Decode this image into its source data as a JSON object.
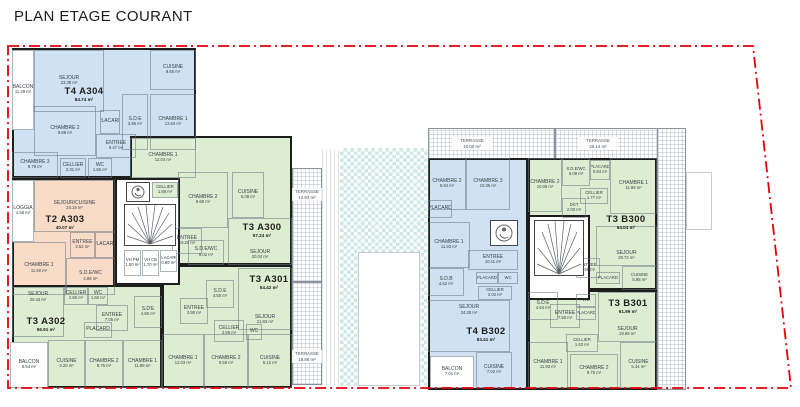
{
  "title": "PLAN ETAGE COURANT",
  "colors": {
    "blue": "#cfe1f2",
    "green": "#dcedd2",
    "orange": "#f8dcc8",
    "wall": "#1d1d1b",
    "boundary": "#e3000b",
    "courtyard": "#cfe7e3"
  },
  "apartments": {
    "a304": {
      "name": "T4  A304",
      "area": "84.74 m²",
      "rooms": {
        "balcon": {
          "n": "BALCON",
          "a": "11.28 m²"
        },
        "sejour": {
          "n": "SEJOUR",
          "a": "23.38 m²"
        },
        "cuisine": {
          "n": "CUISINE",
          "a": "9.65 m²"
        },
        "sde": {
          "n": "S.D.E",
          "a": "3.95 m²"
        },
        "chambre1": {
          "n": "CHAMBRE 1",
          "a": "12.64 m²"
        },
        "chambre2": {
          "n": "CHAMBRE 2",
          "a": "9.88 m²"
        },
        "chambre3": {
          "n": "CHAMBRE 3",
          "a": "9.79 m²"
        },
        "placard": {
          "n": "PLACARD",
          "a": ""
        },
        "entree": {
          "n": "ENTREE",
          "a": "9.47 m²"
        },
        "cellier": {
          "n": "CELLIER",
          "a": "2.31 m²"
        },
        "wc": {
          "n": "WC",
          "a": "1.65 m²"
        }
      }
    },
    "a303": {
      "name": "T2  A303",
      "area": "40.07 m²",
      "rooms": {
        "loggia": {
          "n": "LOGGIA",
          "a": "4.58 m²"
        },
        "sejour_cuisine": {
          "n": "SEJOUR/CUISINE",
          "a": "24.19 m²"
        },
        "entree": {
          "n": "ENTREE",
          "a": "3.52 m²"
        },
        "placard": {
          "n": "PLACARD",
          "a": ""
        },
        "chambre": {
          "n": "CHAMBRE 1",
          "a": "11.50 m²"
        },
        "sde_wc": {
          "n": "S.D.E/WC",
          "a": "4.86 m²"
        }
      }
    },
    "a300": {
      "name": "T3  A300",
      "area": "57.24 m²",
      "rooms": {
        "chambre1": {
          "n": "CHAMBRE 1",
          "a": "12.04 m²"
        },
        "chambre2": {
          "n": "CHAMBRE 2",
          "a": "9.69 m²"
        },
        "cuisine": {
          "n": "CUISINE",
          "a": "5.08 m²"
        },
        "sejour": {
          "n": "SEJOUR",
          "a": "20.04 m²"
        },
        "entree": {
          "n": "ENTREE",
          "a": "10.20 m²"
        },
        "sde_wc": {
          "n": "S.D.E/WC",
          "a": "5.02 m²"
        },
        "cellier": {
          "n": "CELLIER",
          "a": "1.88 m²"
        },
        "terrasse": {
          "n": "TERRASSE",
          "a": "12.93 m²"
        }
      }
    },
    "a301": {
      "name": "T3  A301",
      "area": "54.42 m²",
      "rooms": {
        "sde": {
          "n": "S.D.E",
          "a": "4.50 m²"
        },
        "sejour": {
          "n": "SEJOUR",
          "a": "21.83 m²"
        },
        "entree": {
          "n": "ENTREE",
          "a": "3.90 m²"
        },
        "cellier": {
          "n": "CELLIER",
          "a": "2.65 m²"
        },
        "wc": {
          "n": "WC",
          "a": ""
        },
        "chambre1": {
          "n": "CHAMBRE 1",
          "a": "12.03 m²"
        },
        "chambre2": {
          "n": "CHAMBRE 2",
          "a": "9.58 m²"
        },
        "cuisine": {
          "n": "CUISINE",
          "a": "5.12 m²"
        },
        "terrasse": {
          "n": "TERRASSE",
          "a": "18.88 m²"
        }
      }
    },
    "a302": {
      "name": "T3  A302",
      "area": "55.91 m²",
      "rooms": {
        "sejour": {
          "n": "SEJOUR",
          "a": "20.43 m²"
        },
        "cellier": {
          "n": "CELLIER",
          "a": "2.60 m²"
        },
        "wc": {
          "n": "WC",
          "a": "1.60 m²"
        },
        "entree": {
          "n": "ENTREE",
          "a": "7.05 m²"
        },
        "sde": {
          "n": "S.D'E",
          "a": "4.60 m²"
        },
        "placard": {
          "n": "PLACARD",
          "a": ""
        },
        "cuisine": {
          "n": "CUISINE",
          "a": "4.20 m²"
        },
        "chambre1": {
          "n": "CHAMBRE 1",
          "a": "11.98 m²"
        },
        "chambre2": {
          "n": "CHAMBRE 2",
          "a": "9.75 m²"
        },
        "balcon": {
          "n": "BALCON",
          "a": "8.54 m²"
        }
      }
    },
    "b300": {
      "name": "T3  B300",
      "area": "64.04 m²",
      "rooms": {
        "chambre1": {
          "n": "CHAMBRE 1",
          "a": "11.99 m²"
        },
        "chambre2": {
          "n": "CHAMBRE 2",
          "a": "10.06 m²"
        },
        "sde_wc": {
          "n": "S.D.E/WC",
          "a": "5.09 m²"
        },
        "placard": {
          "n": "PLACARD",
          "a": "0.84 m²"
        },
        "cellier": {
          "n": "CELLIER",
          "a": "1.77 m²"
        },
        "dgt": {
          "n": "DGT",
          "a": "2.00 m²"
        },
        "sejour": {
          "n": "SEJOUR",
          "a": "20.72 m²"
        },
        "entree": {
          "n": "ENTREE",
          "a": "3.98 m²"
        },
        "placard2": {
          "n": "PLACARD",
          "a": "0.70 m²"
        },
        "cuisine": {
          "n": "CUISINE",
          "a": "5.98 m²"
        },
        "terrasse": {
          "n": "TERRASSE",
          "a": "20.14 m²"
        }
      }
    },
    "b301": {
      "name": "T3  B301",
      "area": "61.99 m²",
      "rooms": {
        "sde": {
          "n": "S.D.E",
          "a": "4.54 m²"
        },
        "entree": {
          "n": "ENTREE",
          "a": "7.50 m²"
        },
        "wc": {
          "n": "WC",
          "a": "1.65 m²"
        },
        "placard": {
          "n": "PLACARD",
          "a": "0.92 m²"
        },
        "sejour": {
          "n": "SEJOUR",
          "a": "20.65 m²"
        },
        "cellier": {
          "n": "CELLIER",
          "a": "1.63 m²"
        },
        "chambre1": {
          "n": "CHAMBRE 1",
          "a": "11.93 m²"
        },
        "chambre2": {
          "n": "CHAMBRE 2",
          "a": "9.75 m²"
        },
        "cuisine": {
          "n": "CUISINE",
          "a": "5.44 m²"
        }
      }
    },
    "b302": {
      "name": "T4  B302",
      "area": "83.41 m²",
      "rooms": {
        "chambre1": {
          "n": "CHAMBRE 1",
          "a": "11.93 m²"
        },
        "chambre2": {
          "n": "CHAMBRE 2",
          "a": "9.94 m²"
        },
        "chambre3": {
          "n": "CHAMBRE 3",
          "a": "10.35 m²"
        },
        "placard": {
          "n": "PLACARD",
          "a": ""
        },
        "entree": {
          "n": "ENTREE",
          "a": "10.11 m²"
        },
        "sdb": {
          "n": "S.D.B",
          "a": "4.52 m²"
        },
        "placard2": {
          "n": "PLACARD",
          "a": "0.97 m²"
        },
        "wc": {
          "n": "WC",
          "a": "1.70 m²"
        },
        "cellier": {
          "n": "CELLIER",
          "a": "2.02 m²"
        },
        "sejour": {
          "n": "SEJOUR",
          "a": "24.30 m²"
        },
        "cuisine": {
          "n": "CUISINE",
          "a": "7.02 m²"
        },
        "balcon": {
          "n": "BALCON",
          "a": "7.01 m²"
        },
        "terrasse": {
          "n": "TERRASSE",
          "a": "10.00 m²"
        }
      }
    }
  },
  "common": {
    "core_a": {
      "vh_pm": {
        "n": "VH PM",
        "a": "1.50 m²"
      },
      "vh_cb": {
        "n": "VH CB",
        "a": "1.70 m²"
      },
      "placard": {
        "n": "PLACARD",
        "a": "0.89 m²"
      }
    }
  }
}
